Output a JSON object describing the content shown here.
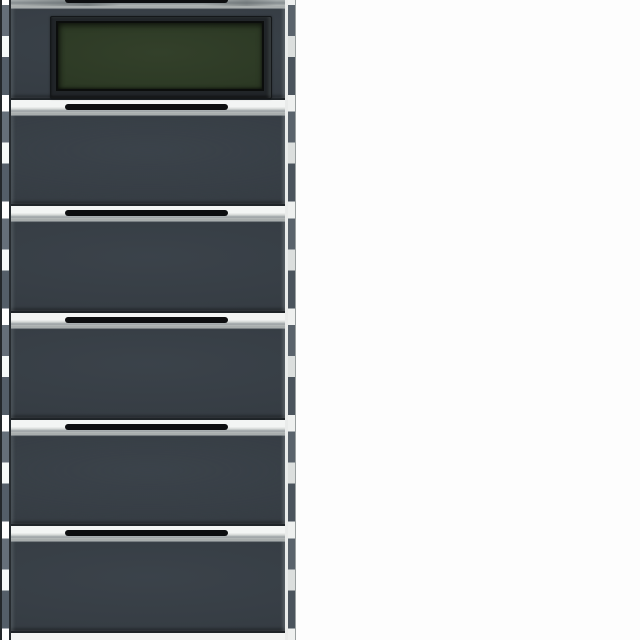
{
  "image": {
    "kind": "product-photo",
    "background_color": "#fdfdfd"
  },
  "device": {
    "name": "multi-gang push-button wall switch with display",
    "finish": "anthracite",
    "row_count": 6,
    "rows": [
      {
        "id": "display-module",
        "kind": "display",
        "interactable": true
      },
      {
        "id": "rocker-button-1",
        "kind": "button",
        "interactable": true
      },
      {
        "id": "rocker-button-2",
        "kind": "button",
        "interactable": true
      },
      {
        "id": "rocker-button-3",
        "kind": "button",
        "interactable": true
      },
      {
        "id": "rocker-button-4",
        "kind": "button",
        "interactable": true
      },
      {
        "id": "rocker-button-5",
        "kind": "button",
        "interactable": true
      }
    ],
    "display": {
      "state": "off",
      "screen_color": "#2d3a25",
      "bezel_color": "#212528"
    },
    "colors": {
      "button_face": "#373e45",
      "face_top_highlight": "#a9aeae",
      "face_bottom_shadow": "#1f2428",
      "gap_band": "#f3f5f4",
      "separator_slot": "#0d0e10",
      "rail_grey": "#5a636c",
      "rail_grey_dark": "#4b545d",
      "rail_light": "#dcdfde",
      "rail_white": "#eef0ef",
      "edge_dark": "#24282b",
      "divider_light": "#e9ebea"
    }
  }
}
